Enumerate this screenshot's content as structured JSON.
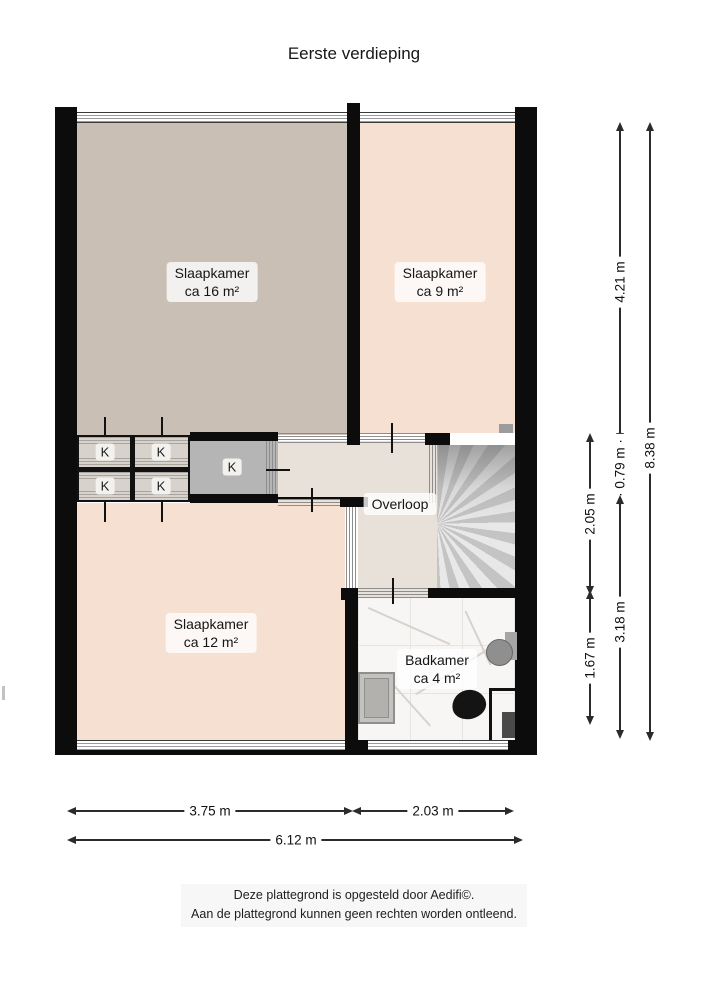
{
  "title": "Eerste verdieping",
  "plan": {
    "rooms": {
      "bedroom16": {
        "name": "Slaapkamer",
        "area": "ca 16 m²"
      },
      "bedroom9": {
        "name": "Slaapkamer",
        "area": "ca 9 m²"
      },
      "bedroom12": {
        "name": "Slaapkamer",
        "area": "ca 12 m²"
      },
      "landing": {
        "name": "Overloop"
      },
      "bathroom": {
        "name": "Badkamer",
        "area": "ca 4 m²"
      }
    },
    "closet_label": "K",
    "fixtures": [
      "stairs",
      "radiator",
      "toilet",
      "sink",
      "shower",
      "window"
    ]
  },
  "dimensions": {
    "right_inner_top": "2.05 m",
    "right_inner_bottom": "1.67 m",
    "right_mid_top": "4.21 m",
    "right_mid_small": "0.79 m",
    "right_mid_bottom": "3.18 m",
    "right_outer": "8.38 m",
    "bottom_left": "3.75 m",
    "bottom_right": "2.03 m",
    "bottom_total": "6.12 m"
  },
  "footer": {
    "line1": "Deze plattegrond is opgesteld door Aedifi©.",
    "line2": "Aan de plattegrond kunnen geen rechten worden ontleend."
  },
  "colors": {
    "wall": "#0c0c0c",
    "floor_taupe": "#c9bfb4",
    "floor_pink": "#f6e0d2",
    "floor_landing": "#e7e1da",
    "closet_grey": "#b5b5b5",
    "stairs_grey": "#dcdcdc",
    "bathroom_floor": "#f7f6f4",
    "dim_line": "#2b2b2b",
    "text": "#1a1a1a"
  }
}
